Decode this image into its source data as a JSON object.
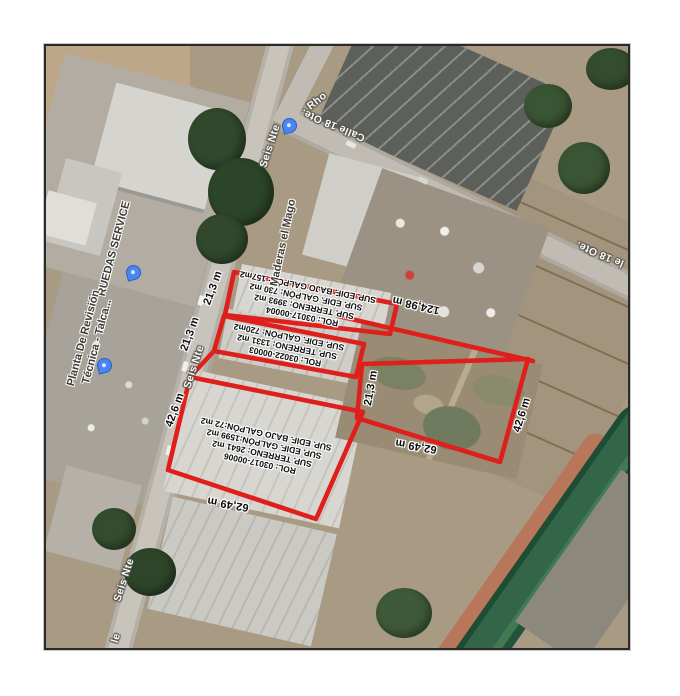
{
  "document": {
    "type": "satellite-parcel-plan"
  },
  "colors": {
    "boundary_red": "#df1f1c",
    "pin_blue": "#4886f4"
  },
  "parcel_annotations": [
    {
      "name": "parcel-annotation-03017-00004",
      "x": 259,
      "y": 256,
      "rot": 191,
      "lines": [
        "ROL: 03017-00004",
        "SUP. TERRENO: 3993 m2",
        "SUP. EDIF. GALPÓN: 730 m2",
        "SUP. EDIF. BAJO GALPÓN: 157m2"
      ]
    },
    {
      "name": "parcel-annotation-03022-00003",
      "x": 241,
      "y": 301,
      "rot": 191,
      "lines": [
        "ROL: 03022-00003",
        "SUP. TERRENO: 1331 m2",
        "SUP. EDIF. GALPÓN: 720m2"
      ]
    },
    {
      "name": "parcel-annotation-03017-00006",
      "x": 217,
      "y": 403,
      "rot": 192,
      "lines": [
        "ROL: 03017-00006",
        "SUP. TERRENO: 2641 m2",
        "SUP. EDIF. GALPÓN:1599 m2",
        "SUP. EDIF. BAJO GALPÓN:72 m2"
      ]
    }
  ],
  "measurements": [
    {
      "text": "21,3 m",
      "x": 167,
      "y": 242,
      "rot": -70
    },
    {
      "text": "21,3 m",
      "x": 144,
      "y": 288,
      "rot": -70
    },
    {
      "text": "21,3 m",
      "x": 325,
      "y": 342,
      "rot": -80
    },
    {
      "text": "42,6 m",
      "x": 129,
      "y": 364,
      "rot": -70
    },
    {
      "text": "42,6 m",
      "x": 476,
      "y": 369,
      "rot": -73
    },
    {
      "text": "62,49 m",
      "x": 182,
      "y": 458,
      "rot": 190
    },
    {
      "text": "62,49 m",
      "x": 370,
      "y": 400,
      "rot": 190
    },
    {
      "text": "124,98 m",
      "x": 370,
      "y": 259,
      "rot": 193
    }
  ],
  "street_labels": [
    {
      "text": "Rho",
      "x": 271,
      "y": 55,
      "rot": -38
    },
    {
      "text": "Calle 18 Ote.",
      "x": 287,
      "y": 79,
      "rot": 203
    },
    {
      "text": "le 18 Ote.",
      "x": 554,
      "y": 208,
      "rot": 203
    },
    {
      "text": "Seis Nte",
      "x": 224,
      "y": 100,
      "rot": -72
    },
    {
      "text": "Seis Nte",
      "x": 148,
      "y": 321,
      "rot": -72
    },
    {
      "text": "Seis Nte",
      "x": 78,
      "y": 534,
      "rot": -72
    },
    {
      "text": "le",
      "x": 70,
      "y": 592,
      "rot": -72
    }
  ],
  "poi_labels": [
    {
      "text": "Maderas el Mago",
      "x": 238,
      "y": 197,
      "rot": -78
    },
    {
      "text": "RUEDAS SERVICE",
      "x": 69,
      "y": 203,
      "rot": -75
    },
    {
      "text": "Planta De Revisión\nTécnica - Talca...",
      "x": 45,
      "y": 294,
      "rot": -75
    }
  ],
  "pins": [
    {
      "name": "map-pin-seis-nte",
      "x": 242,
      "y": 84
    },
    {
      "name": "map-pin-ruedas",
      "x": 86,
      "y": 231
    },
    {
      "name": "map-pin-planta",
      "x": 57,
      "y": 324
    }
  ]
}
